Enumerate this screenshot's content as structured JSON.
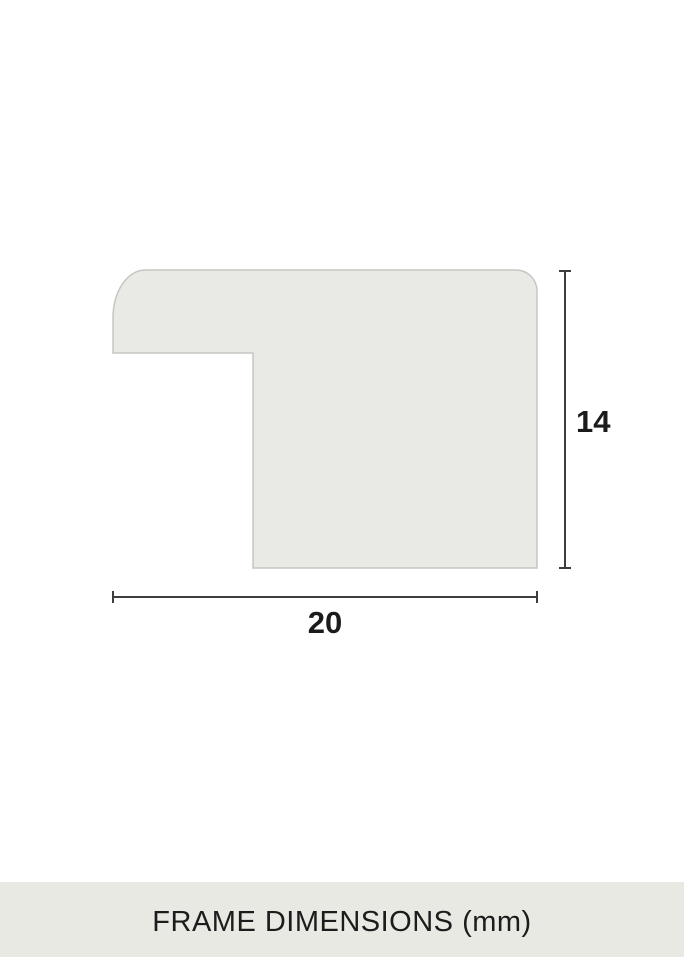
{
  "diagram": {
    "title": "frame-profile-cross-section",
    "width_label": "20",
    "height_label": "14",
    "shape_fill": "#e9e9e5",
    "shape_stroke": "#c6c6c2",
    "dimension_line_color": "#3d3d3d",
    "label_color": "#1b1b1b"
  },
  "footer": {
    "caption": "FRAME DIMENSIONS (mm)",
    "background": "#e9e9e4",
    "text_color": "#1c1c1c"
  }
}
